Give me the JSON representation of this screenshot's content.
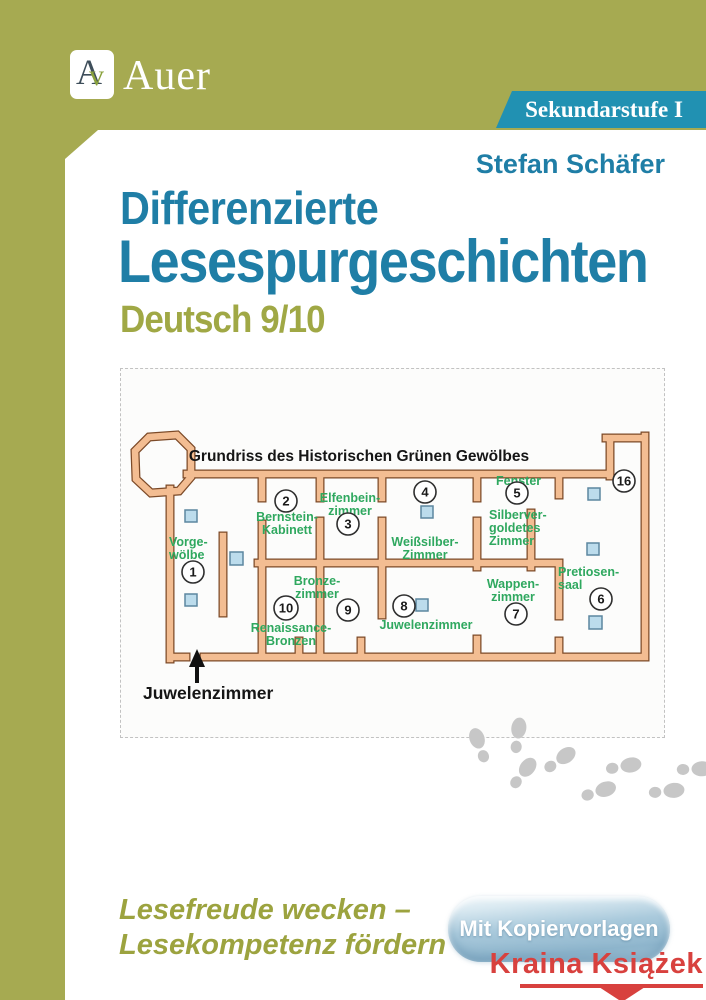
{
  "brand": {
    "monogram_a": "A",
    "monogram_v": "v",
    "name": "Auer",
    "series_badge": "Sekundarstufe I"
  },
  "cover": {
    "author": "Stefan Schäfer",
    "title_line1": "Differenzierte",
    "title_line2": "Lesespurgeschichten",
    "subtitle": "Deutsch 9/10"
  },
  "map": {
    "title": "Grundriss des Historischen Grünen Gewölbes",
    "entrance_label": "Juwelenzimmer",
    "rooms": [
      {
        "num": "1",
        "l1": "Vorge-",
        "l2": "wölbe"
      },
      {
        "num": "2",
        "l1": "Bernstein-",
        "l2": "Kabinett"
      },
      {
        "num": "3",
        "l1": "Elfenbein-",
        "l2": "zimmer"
      },
      {
        "num": "4",
        "l1": "Weißsilber-",
        "l2": "Zimmer"
      },
      {
        "num": "5",
        "l1": "Silberver-",
        "l2": "goldetes",
        "l3": "Zimmer"
      },
      {
        "num": "6",
        "l1": "Pretiosen-",
        "l2": "saal"
      },
      {
        "num": "7",
        "l1": "Wappen-",
        "l2": "zimmer"
      },
      {
        "num": "8",
        "l1": "Juwelenzimmer"
      },
      {
        "num": "9",
        "l1": "Bronze-",
        "l2": "zimmer"
      },
      {
        "num": "10",
        "l1": "Renaissance-",
        "l2": "Bronzen"
      },
      {
        "num": "16",
        "l1": "Fenster"
      }
    ]
  },
  "footer": {
    "claim_line1": "Lesefreude wecken –",
    "claim_line2": "Lesekompetenz fördern",
    "badge": "Mit Kopiervorlagen",
    "watermark": "Kraina Książek"
  },
  "colors": {
    "olive": "#a6aa51",
    "teal_text": "#1f7ea6",
    "banner_teal": "#2191b2",
    "room_green": "#2fa85f",
    "wall_fill": "#f3bd92",
    "wall_outline": "#7c4a28",
    "marker_blue": "#bcdcec",
    "footprint_gray": "#c7c7c7",
    "watermark_red": "#d8413e"
  }
}
